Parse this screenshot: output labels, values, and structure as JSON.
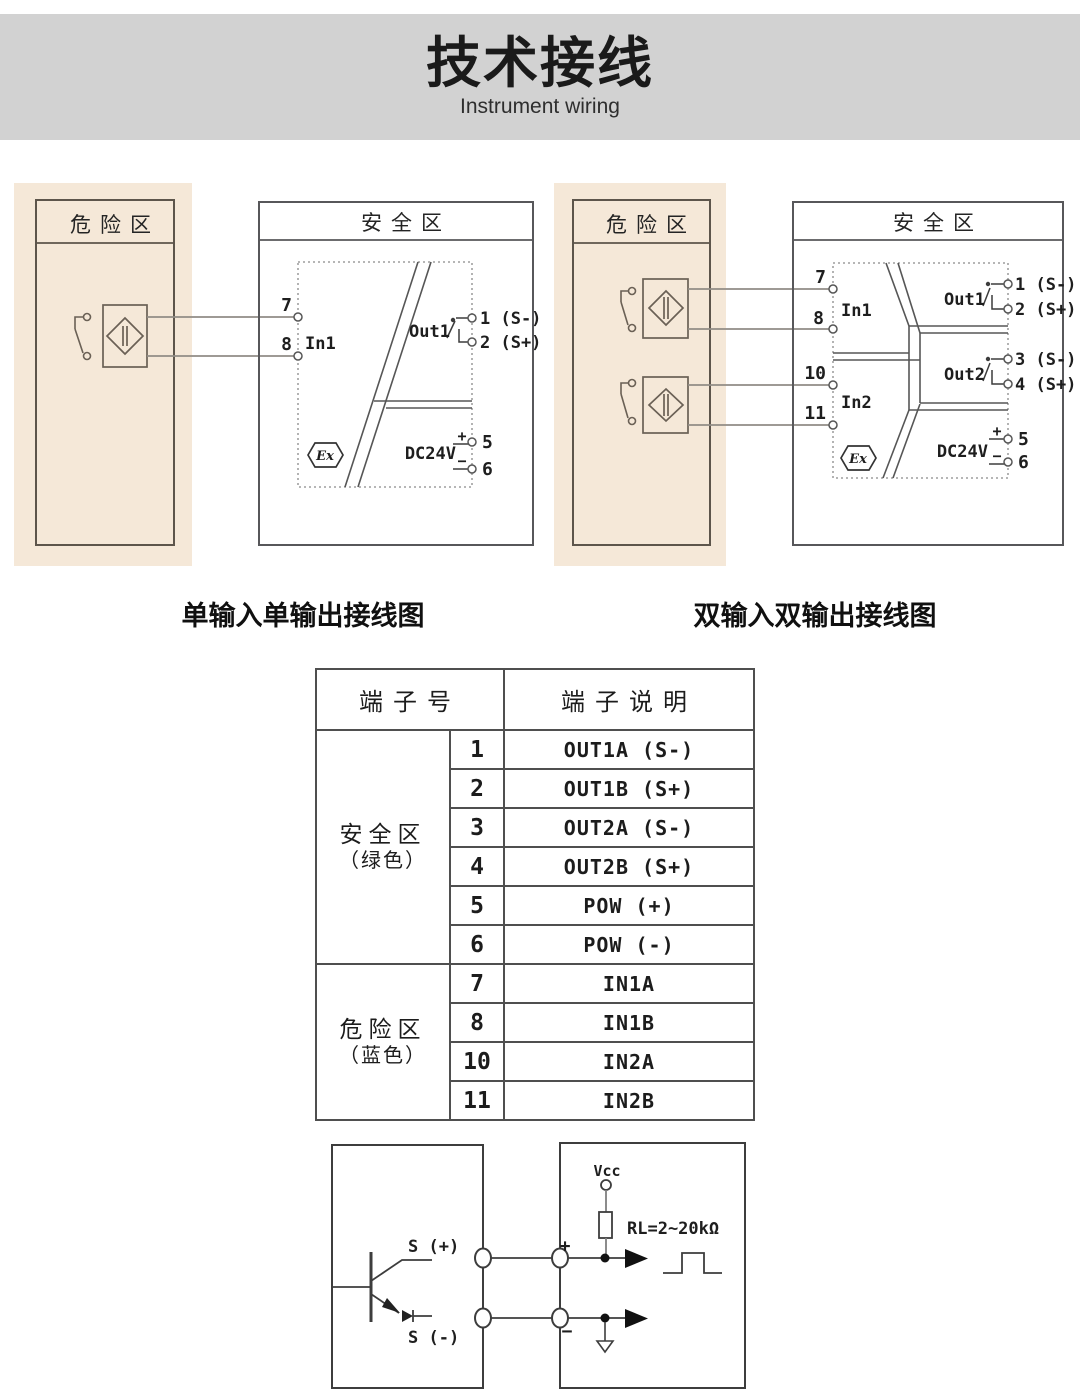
{
  "header": {
    "title": "技术接线",
    "subtitle": "Instrument wiring"
  },
  "colors": {
    "header_band": "#d2d2d2",
    "hazard_zone_bg": "#f5e8d8",
    "diagram_line": "#565656",
    "hazard_line": "#5d554b",
    "wire": "#918c86",
    "circuit_line": "#3d3d3d",
    "text": "#1e1e1e"
  },
  "diagram_single": {
    "caption": "单输入单输出接线图",
    "hazard_label": "危险区",
    "safe_label": "安全区",
    "in_terminal_7": "7",
    "in_terminal_8": "8",
    "in_label": "In1",
    "out_label": "Out1",
    "out_terminal_1": "1 (S-)",
    "out_terminal_2": "2 (S+)",
    "power_label": "DC24V",
    "power_terminal_5": "5",
    "power_terminal_6": "6",
    "polarity_plus": "+",
    "polarity_minus": "−",
    "ex_mark": "Ex"
  },
  "diagram_dual": {
    "caption": "双输入双输出接线图",
    "hazard_label": "危险区",
    "safe_label": "安全区",
    "in_terminal_7": "7",
    "in_terminal_8": "8",
    "in_terminal_10": "10",
    "in_terminal_11": "11",
    "in1_label": "In1",
    "in2_label": "In2",
    "out1_label": "Out1",
    "out1_terminal_1": "1 (S-)",
    "out1_terminal_2": "2 (S+)",
    "out2_label": "Out2",
    "out2_terminal_3": "3 (S-)",
    "out2_terminal_4": "4 (S+)",
    "power_label": "DC24V",
    "power_terminal_5": "5",
    "power_terminal_6": "6",
    "polarity_plus": "+",
    "polarity_minus": "−",
    "ex_mark": "Ex"
  },
  "terminal_table": {
    "header_terminal_no": "端子号",
    "header_terminal_desc": "端子说明",
    "zone_safe_name": "安全区",
    "zone_safe_color": "（绿色）",
    "zone_hazard_name": "危险区",
    "zone_hazard_color": "（蓝色）",
    "rows": [
      {
        "no": "1",
        "desc": "OUT1A (S-)"
      },
      {
        "no": "2",
        "desc": "OUT1B (S+)"
      },
      {
        "no": "3",
        "desc": "OUT2A (S-)"
      },
      {
        "no": "4",
        "desc": "OUT2B (S+)"
      },
      {
        "no": "5",
        "desc": "POW (+)"
      },
      {
        "no": "6",
        "desc": "POW (-)"
      },
      {
        "no": "7",
        "desc": "IN1A"
      },
      {
        "no": "8",
        "desc": "IN1B"
      },
      {
        "no": "10",
        "desc": "IN2A"
      },
      {
        "no": "11",
        "desc": "IN2B"
      }
    ]
  },
  "output_circuit": {
    "s_plus": "S (+)",
    "s_minus": "S (-)",
    "vcc": "Vcc",
    "load_resistor": "RL=2~20kΩ",
    "plus": "+",
    "minus": "−"
  }
}
